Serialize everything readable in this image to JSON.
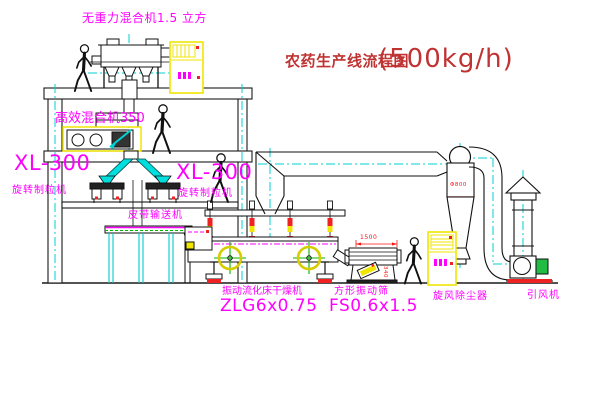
{
  "diagram": {
    "title": {
      "text": "农药生产线流程图",
      "capacity": "(500kg/h)"
    },
    "equipment_labels": {
      "gravity_mixer": "无重力混合机1.5 立方",
      "high_eff_mixer": "高效混合机350",
      "granulator_left": {
        "model": "XL-300",
        "name": "旋转制粒机"
      },
      "granulator_right": {
        "model": "XL-300",
        "name": "旋转制粒机"
      },
      "belt_conveyor": "皮带输送机",
      "fluid_bed_dryer": {
        "name": "振动流化床干燥机",
        "model": "ZLG6x0.75"
      },
      "vibrating_sieve": {
        "name": "方形振动筛",
        "model": "FS0.6x1.5"
      },
      "cyclone_dust_collector": "旋风除尘器",
      "induced_draft_fan": "引风机"
    },
    "dimensions": {
      "sieve_length": "1500",
      "cyclone_diameter": "Φ800",
      "sieve_height": "340"
    },
    "colors": {
      "label_magenta": "#ff00ff",
      "title_red": "#c03333",
      "dimension_red": "#ff1111",
      "centerline_cyan": "#00d0d0",
      "cabinet_yellow": "#f0e600",
      "cross_green": "#00b400"
    }
  }
}
